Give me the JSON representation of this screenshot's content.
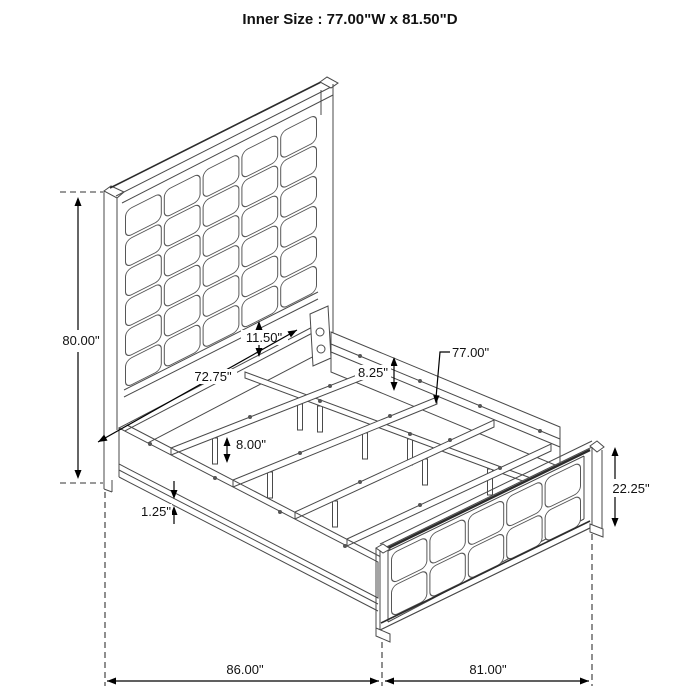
{
  "title": "Inner Size : 77.00\"W x 81.50\"D",
  "dimensions": {
    "headboard_height": "80.00\"",
    "panel_to_rail_gap": "11.50\"",
    "side_rail_length": "72.75\"",
    "side_rail_height": "8.25\"",
    "slat_length": "77.00\"",
    "slat_leg_height": "8.00\"",
    "rail_trim_thickness": "1.25\"",
    "footboard_height": "22.25\"",
    "overall_depth": "86.00\"",
    "overall_width": "81.00\""
  },
  "colors": {
    "line": "#4a4a4a",
    "dimension": "#000000",
    "background": "#ffffff"
  }
}
